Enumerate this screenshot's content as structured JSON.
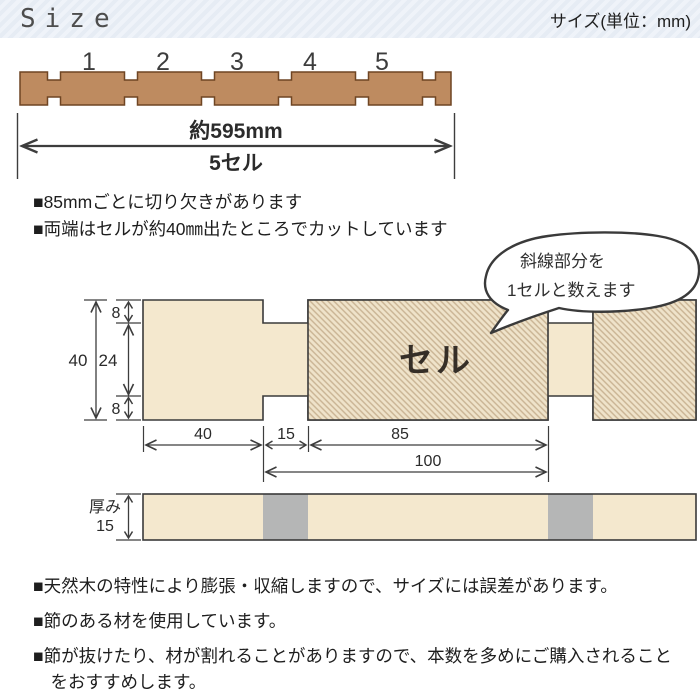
{
  "header": {
    "title": "Size",
    "unit_label": "サイズ(単位：mm)"
  },
  "top_diagram": {
    "cell_numbers": [
      "1",
      "2",
      "3",
      "4",
      "5"
    ],
    "total_length": "約595mm",
    "total_cells": "5セル"
  },
  "notes_top": [
    "■85mmごとに切り欠きがあります",
    "■両端はセルが約40㎜出たところでカットしています"
  ],
  "bubble": {
    "line1": "斜線部分を",
    "line2": "1セルと数えます"
  },
  "cross_section": {
    "cell_label": "セル",
    "dims": {
      "total_height": "40",
      "notch_depth_top": "8",
      "middle": "24",
      "notch_depth_bottom": "8",
      "end_length": "40",
      "notch_width": "15",
      "cell_body": "85",
      "cell_pitch": "100"
    }
  },
  "thickness": {
    "label": "厚み",
    "value": "15"
  },
  "notes_bottom": [
    "■天然木の特性により膨張・収縮しますので、サイズには誤差があります。",
    "■節のある材を使用しています。",
    "■節が抜けたり、材が割れることがありますので、本数を多めにご購入されることをおすすめします。"
  ],
  "colors": {
    "header_bg": "#E8EEF5",
    "wood": "#BE8B60",
    "wood_outline": "#6F4523",
    "panel_beige": "#F4E8CE",
    "hatch_line": "#C9B393",
    "notch_gray": "#B5B6B6",
    "outline": "#3A3A3A"
  }
}
